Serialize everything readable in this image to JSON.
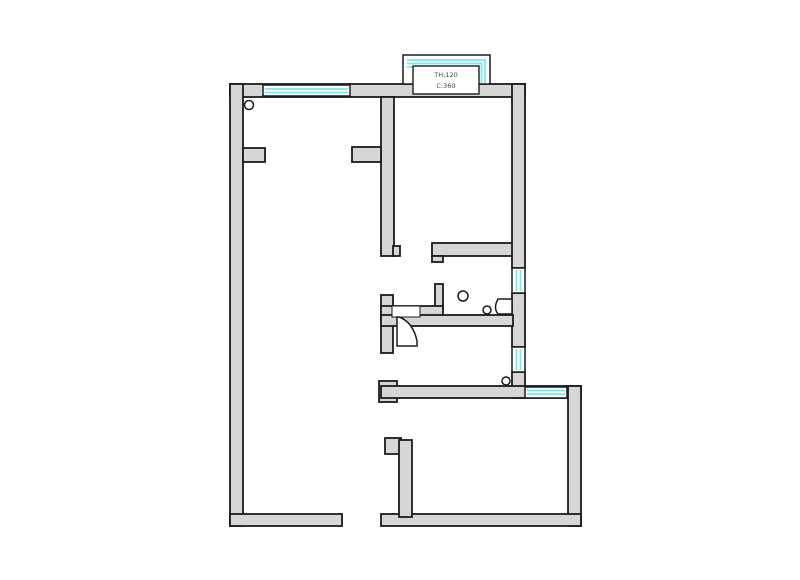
{
  "bay_window": {
    "label_line1": "TH:120",
    "label_line2": "C:360"
  },
  "colors": {
    "background": "#ffffff",
    "wall_fill": "#d6d6d6",
    "wall_stroke": "#1b1b1b",
    "window_accent": "#76e8ef",
    "label_text": "#474747"
  },
  "symbols": {
    "door_stop_top_left": "small-circle",
    "floor_drain": "circle",
    "door_knob": "small-circle",
    "pipe_marker": "small-circle"
  }
}
